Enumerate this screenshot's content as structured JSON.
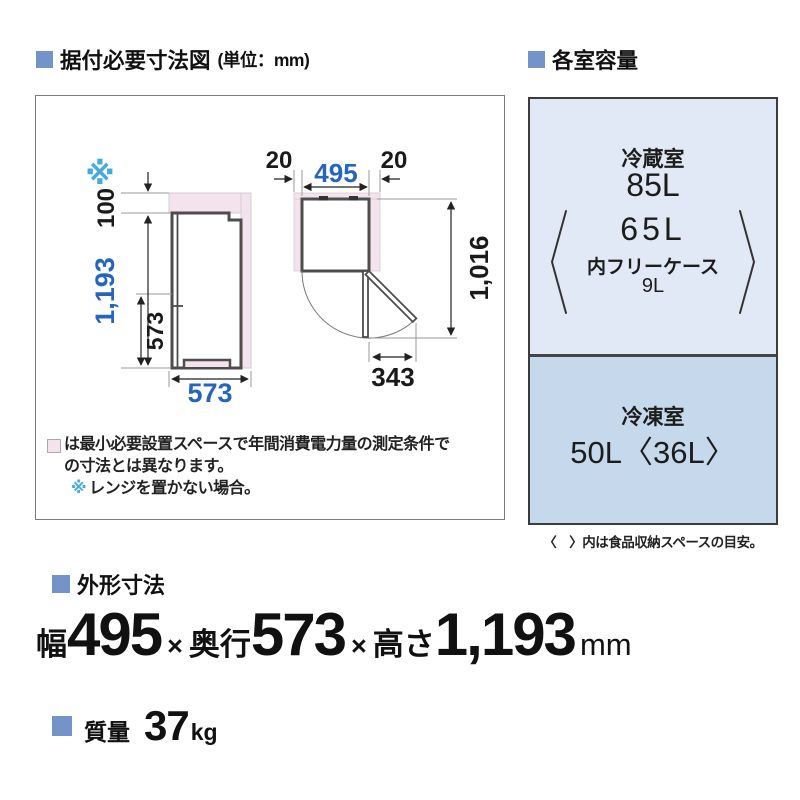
{
  "headers": {
    "installation_title": "据付必要寸法図",
    "installation_unit": "(単位：mm)",
    "capacity_title": "各室容量"
  },
  "diagram": {
    "asterisk": "※",
    "side_view": {
      "top_clearance": "100",
      "total_height": "1,193",
      "lower_door_height": "573",
      "depth": "573"
    },
    "top_view": {
      "left_clearance": "20",
      "width": "495",
      "right_clearance": "20",
      "depth_door_open": "1,016",
      "door_protrusion": "343"
    },
    "notes": {
      "pink_note_line1": "は最小必要設置スペースで年間消費電力量の測定条件で",
      "pink_note_line2": "の寸法とは異なります。",
      "asterisk_note": "レンジを置かない場合。"
    }
  },
  "capacity": {
    "fridge": {
      "label": "冷蔵室",
      "total": "85L",
      "food_space": "65L",
      "case_label": "内フリーケース",
      "case_volume": "9L"
    },
    "freezer": {
      "label": "冷凍室",
      "volume": "50L〈36L〉"
    },
    "note": "〈　〉内は食品収納スペースの目安。"
  },
  "outer_dimensions": {
    "header": "外形寸法",
    "width_label": "幅",
    "width": "495",
    "times1": "×",
    "depth_label": "奥行",
    "depth": "573",
    "times2": "×",
    "height_label": "高さ",
    "height": "1,193",
    "unit": "mm"
  },
  "weight": {
    "header": "質量",
    "value": "37",
    "unit": "kg"
  },
  "colors": {
    "accent_blue": "#7493c8",
    "dim_blue": "#2565bf",
    "asterisk_blue": "#45aadd",
    "install_space_pink": "#f4e2ec",
    "fridge_section_bg": "#e1e9f6",
    "freezer_section_bg": "#c6d8ec"
  }
}
